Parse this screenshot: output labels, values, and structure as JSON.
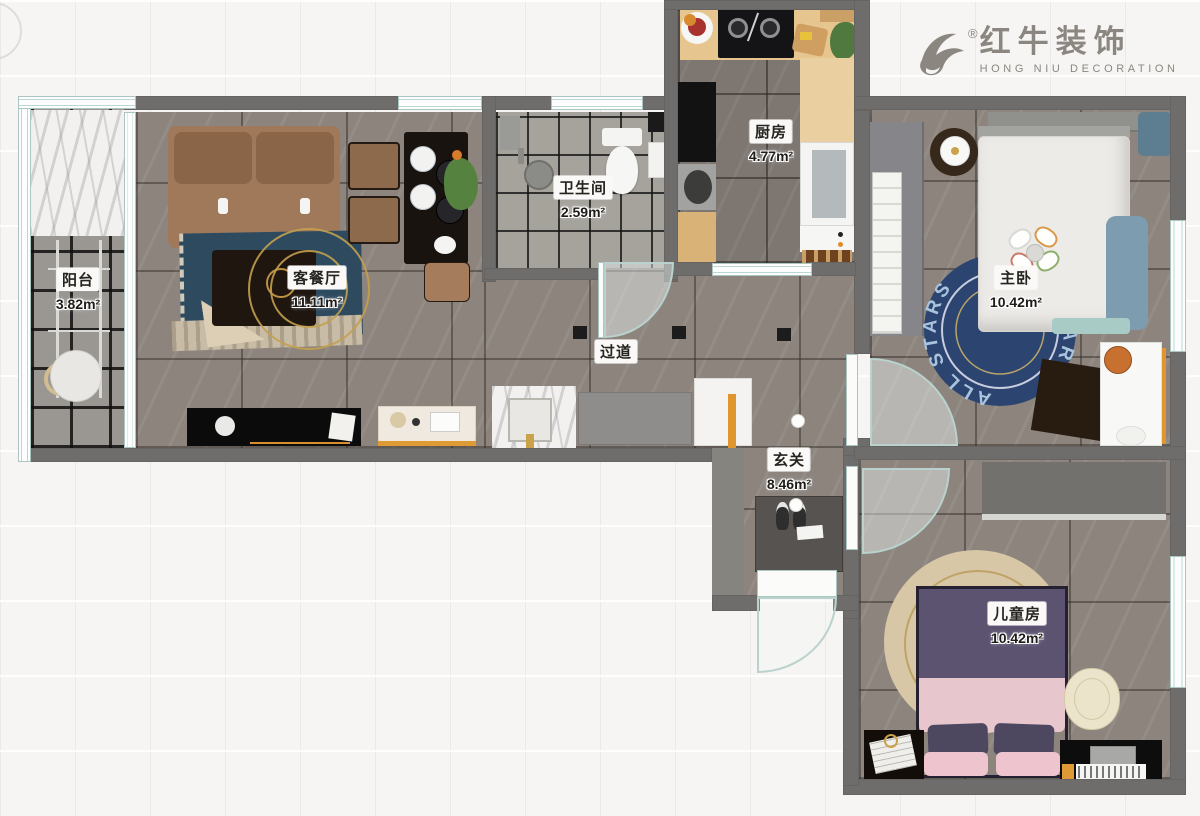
{
  "logo": {
    "brand": "红牛装饰",
    "subtitle": "HONG NIU DECORATION",
    "registered": "®"
  },
  "rooms": {
    "balcony": {
      "name": "阳台",
      "area": "3.82m²"
    },
    "living": {
      "name": "客餐厅",
      "area": "11.11m²"
    },
    "bathroom": {
      "name": "卫生间",
      "area": "2.59m²"
    },
    "kitchen": {
      "name": "厨房",
      "area": "4.77m²"
    },
    "master": {
      "name": "主卧",
      "area": "10.42m²"
    },
    "hallway": {
      "name": "过道",
      "area": ""
    },
    "entry": {
      "name": "玄关",
      "area": "8.46m²"
    },
    "kids": {
      "name": "儿童房",
      "area": "10.42m²"
    }
  },
  "master_rug": {
    "text": "ALL STARS"
  },
  "palette": {
    "wall": "#6e6d6b",
    "accent_orange": "#e0962e",
    "rug_blue": "#2c4470",
    "window_teal": "#b9d2ce",
    "floor_marble": "#8c847d",
    "logo_gray": "#8b8780"
  }
}
